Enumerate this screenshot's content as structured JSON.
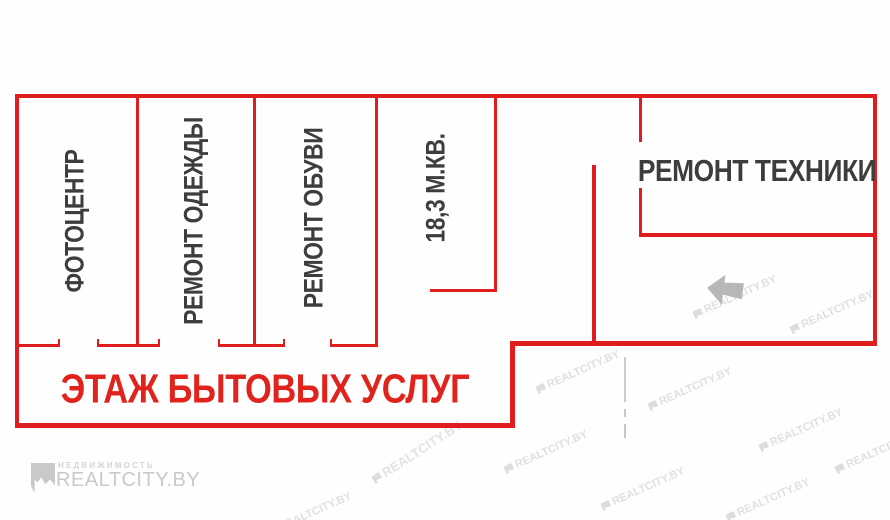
{
  "plan": {
    "title": "ЭТАЖ БЫТОВЫХ УСЛУГ",
    "rooms": [
      {
        "id": "photo-center",
        "label": "ФОТОЦЕНТР"
      },
      {
        "id": "clothes-repair",
        "label": "РЕМОНТ ОДЕЖДЫ"
      },
      {
        "id": "shoe-repair",
        "label": "РЕМОНТ ОБУВИ"
      },
      {
        "id": "vacant-area",
        "label": "18,3 М.КВ."
      },
      {
        "id": "appliance-repair",
        "label": "РЕМОНТ ТЕХНИКИ"
      }
    ],
    "colors": {
      "wall_red": "#e01d1e",
      "title_red": "#e0241d",
      "label_gray": "#3d3d3d",
      "watermark_gray": "#c9c9c9"
    }
  },
  "watermarks": {
    "brand": "REALTCITY.BY",
    "tagline": "НЕДВИЖИМОСТЬ",
    "tile_text": "REALTCITY.BY"
  }
}
